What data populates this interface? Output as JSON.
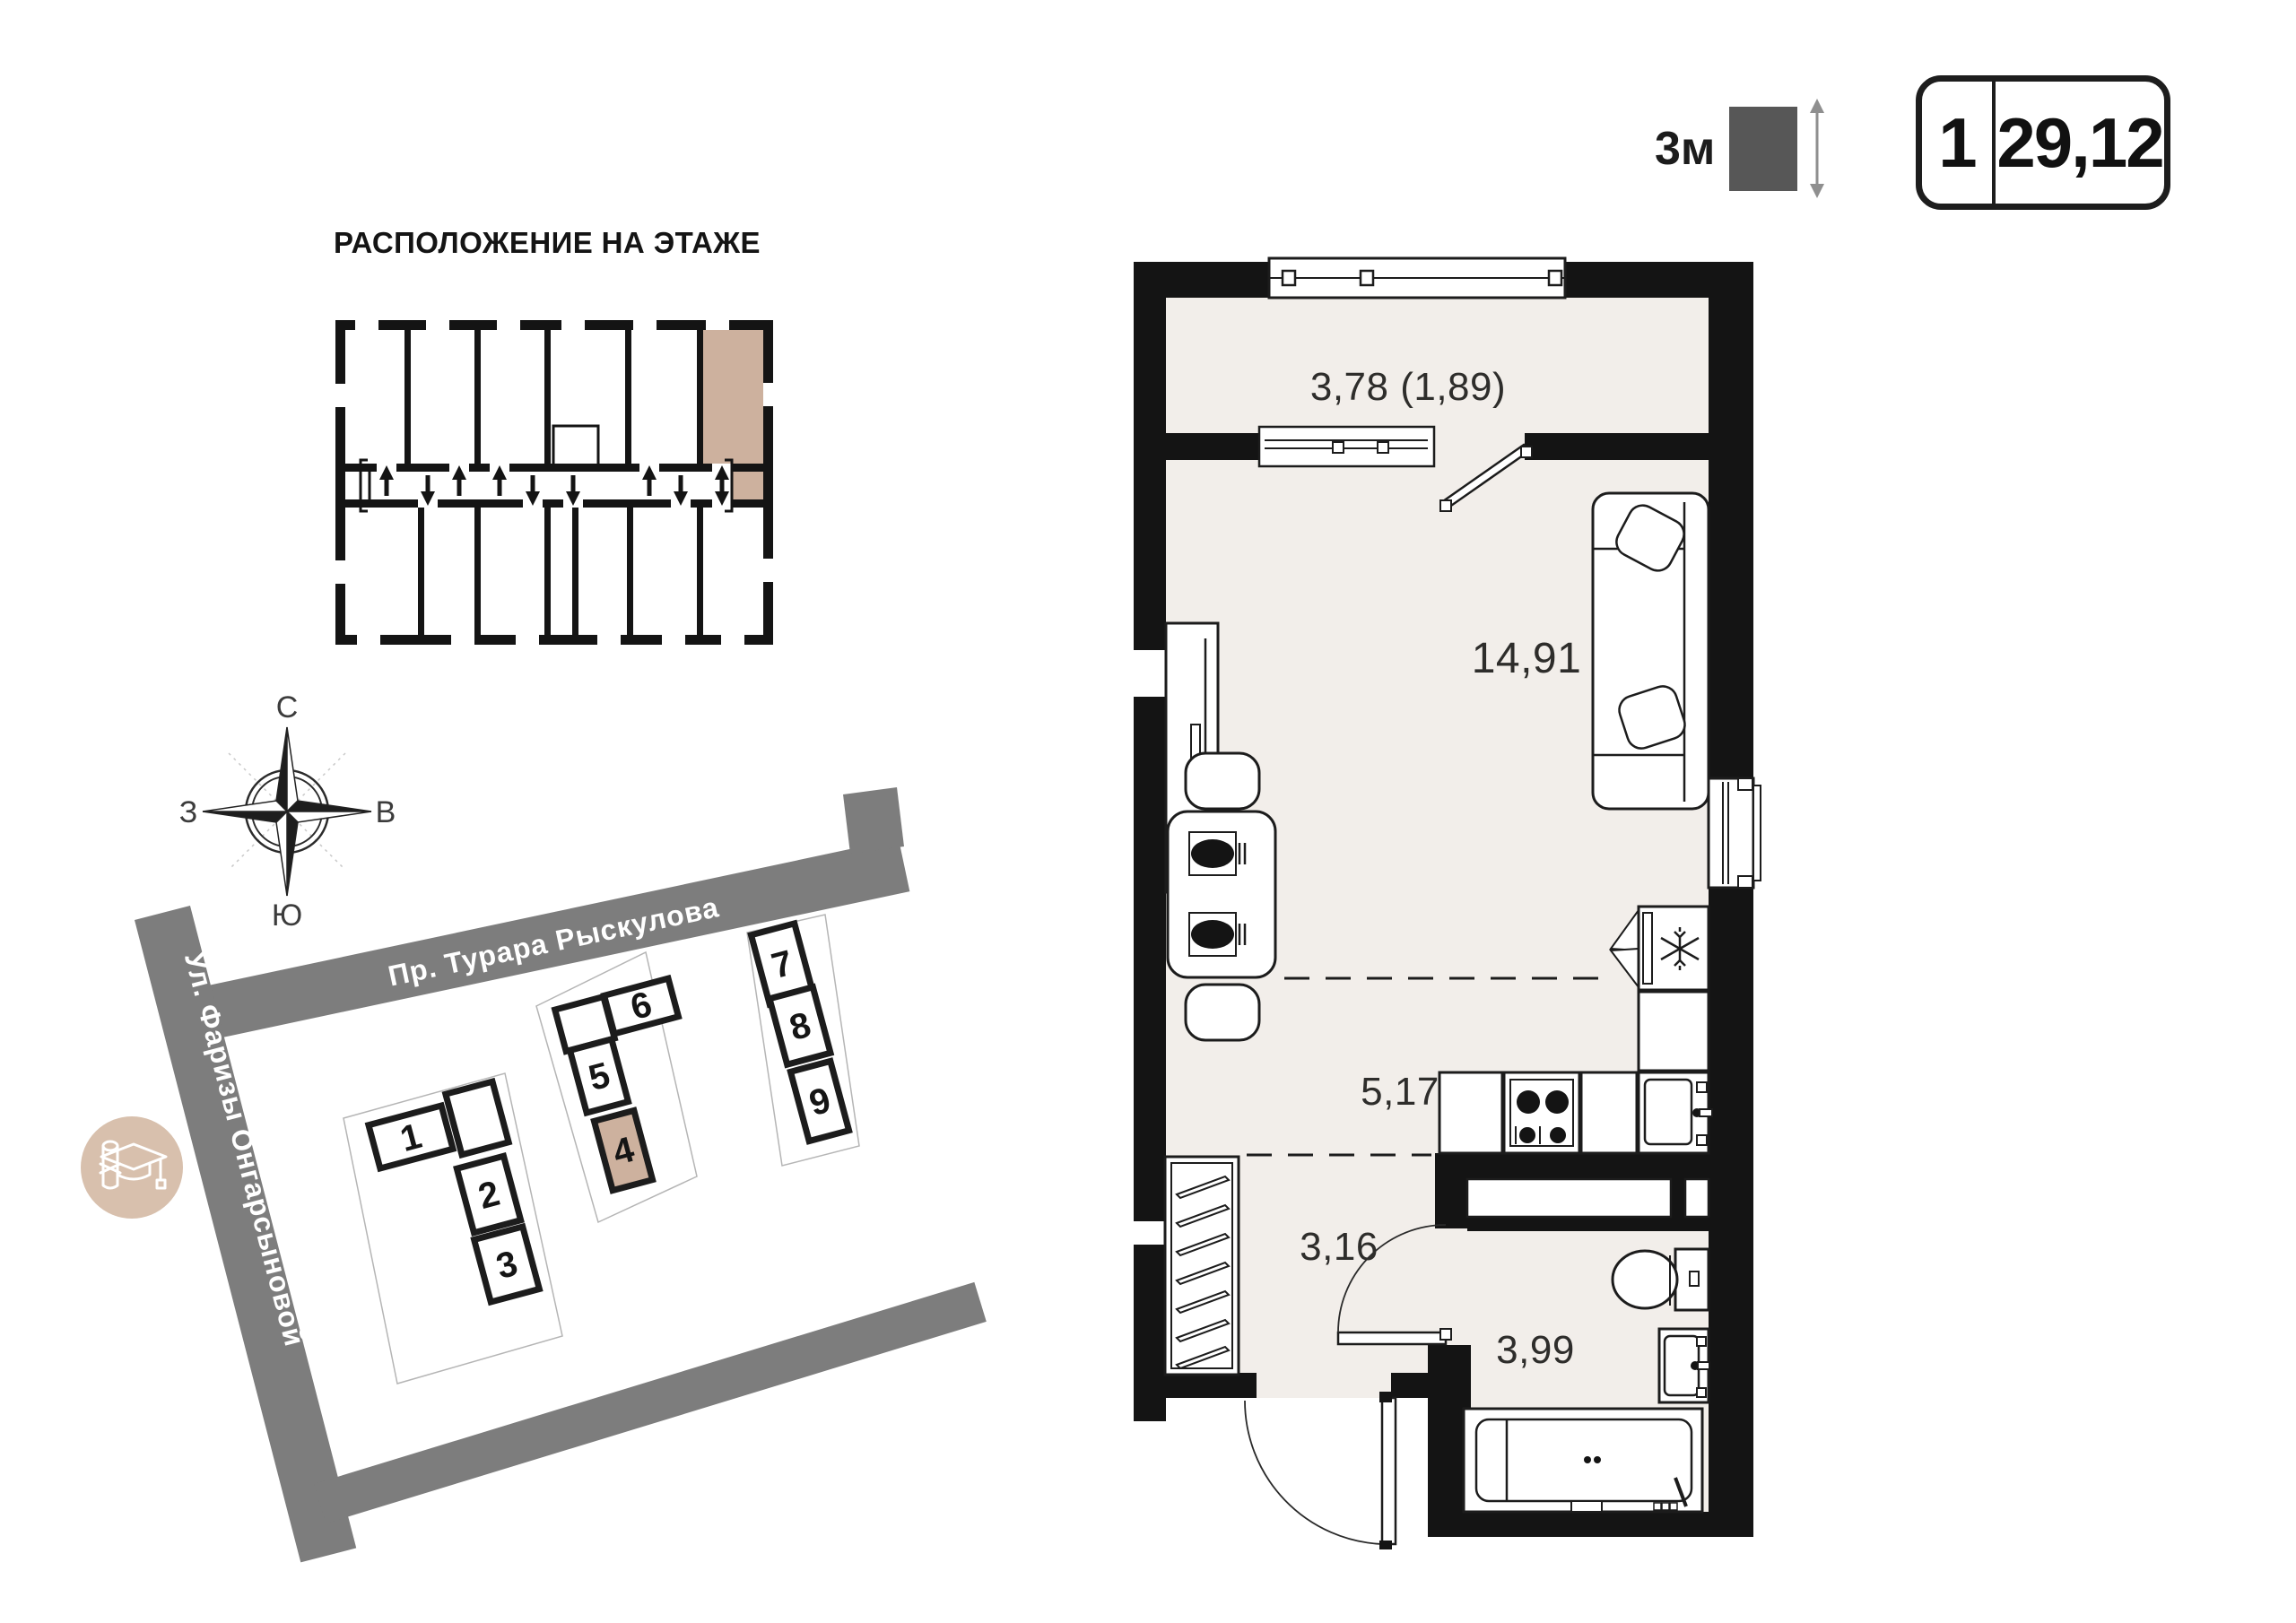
{
  "location_plan": {
    "title": "РАСПОЛОЖЕНИЕ НА ЭТАЖЕ",
    "highlighted_unit": "top-right"
  },
  "unit": {
    "rooms_count": "1",
    "total_area": "29,12",
    "ceiling_height": "3м",
    "areas": {
      "balcony": "3,78 (1,89)",
      "living": "14,91",
      "kitchen": "5,17",
      "hallway": "3,16",
      "bathroom": "3,99"
    }
  },
  "compass": {
    "north": "С",
    "east": "В",
    "south": "Ю",
    "west": "З"
  },
  "site": {
    "street_top": "Пр. Турара Рыскулова",
    "street_left": "Ул. Фаризы Онгарсыновой",
    "highlighted_building": "4",
    "buildings": [
      {
        "label": "1"
      },
      {
        "label": "2"
      },
      {
        "label": "3"
      },
      {
        "label": "4"
      },
      {
        "label": "5"
      },
      {
        "label": "6"
      },
      {
        "label": "7"
      },
      {
        "label": "8"
      },
      {
        "label": "9"
      }
    ],
    "poi": {
      "icon": "graduation-cap-icon"
    }
  },
  "colors": {
    "wall": "#141414",
    "floor": "#f2eeea",
    "accent_tan": "#cdb19e",
    "street_gray": "#7d7d7d",
    "poi_circle": "#d8c0ad",
    "height_square": "#575757"
  }
}
